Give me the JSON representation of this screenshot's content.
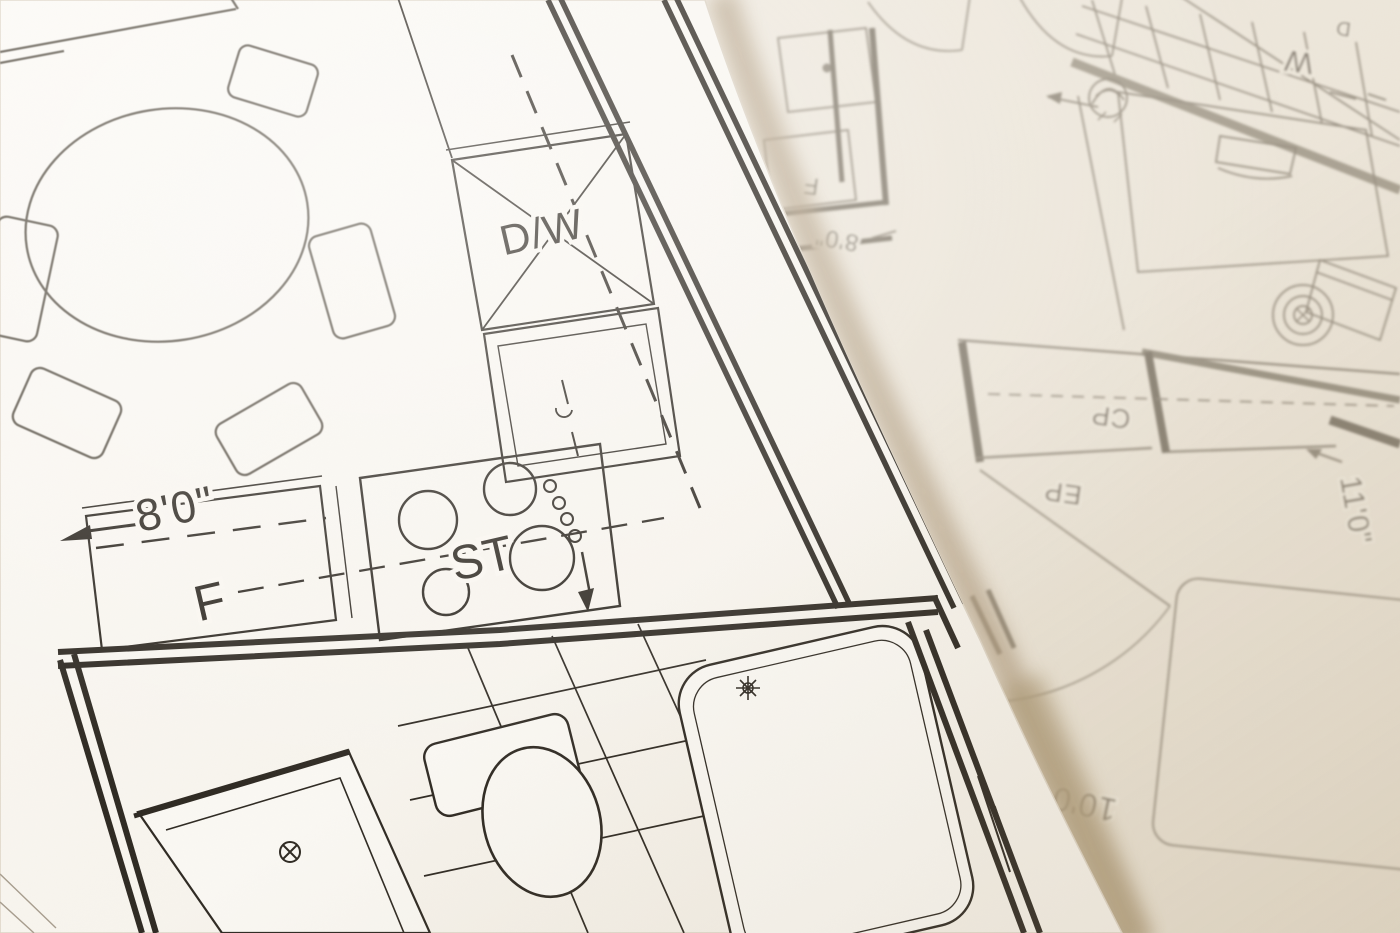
{
  "scene": {
    "type": "photograph of two overlapping architectural blueprint floor plans",
    "note": "lower right sheet is rotated 180 degrees and out of focus"
  },
  "palette": {
    "paper_top": "#faf8f3",
    "paper_bottom": "#efe9de",
    "ink_dark": "#2f2a23",
    "ink_faded": "#8f8678",
    "edge_shadow": "#b3a085"
  },
  "sheet_top": {
    "labels": {
      "dishwasher": "D/W",
      "stove": "ST",
      "refrigerator": "F"
    },
    "dimensions": {
      "counter": "8'0\""
    },
    "features": [
      "round-dining-table",
      "chairs",
      "dishwasher-x-box",
      "sink-cabinet",
      "stove-burners",
      "refrigerator-counter",
      "corridor-double-walls",
      "shower-with-drain",
      "toilet",
      "bathtub-with-faucet",
      "tile-floor-grid",
      "dimension-arrow"
    ]
  },
  "sheet_bottom": {
    "labels": {
      "closet": "CP",
      "entry": "EP",
      "washer": "W",
      "dryer": "D",
      "refrigerator": "F"
    },
    "dimensions": {
      "closet": "11'0\"",
      "room": "10'0\"",
      "counter": "8'0\""
    },
    "features": [
      "tiled-grid-area",
      "bed-with-pillow",
      "side-table-circles",
      "book",
      "closet-with-rod",
      "door-swing",
      "area-rug",
      "fixture-swirl",
      "mirrored-kitchen-fragment"
    ]
  }
}
